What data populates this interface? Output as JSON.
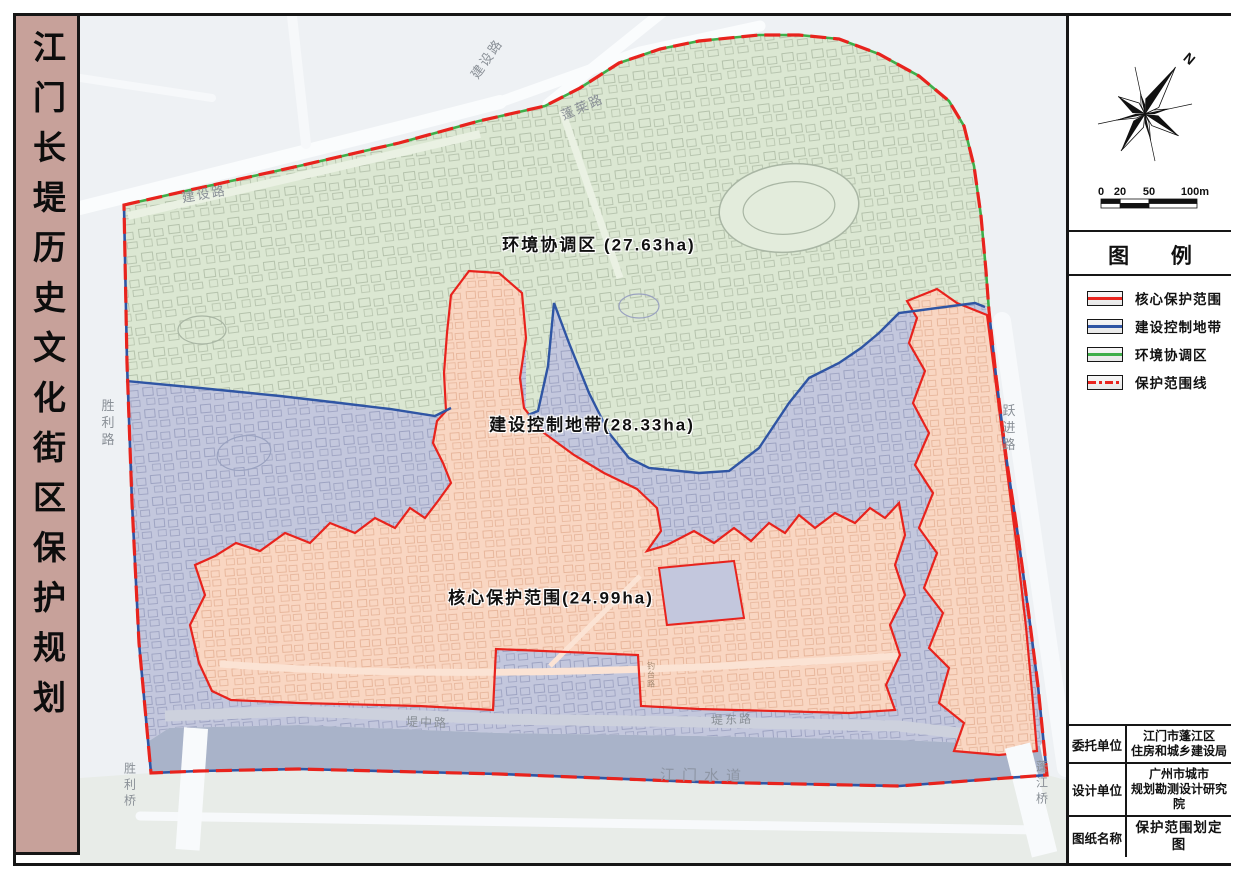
{
  "title_bar": {
    "text": "江门长堤历史文化街区保护规划"
  },
  "map": {
    "zone_labels": {
      "coordination": "环境协调区 (27.63ha)",
      "control": "建设控制地带(28.33ha)",
      "core": "核心保护范围(24.99ha)"
    },
    "road_labels": {
      "jianshe_lu_main": "建设路",
      "jianshe_lu_branch": "建设路",
      "penglai_lu": "蓬莱路",
      "shengli_lu": "胜利路",
      "yuejin_lu": "跃进路",
      "dizhong_lu": "堤中路",
      "didong_lu": "堤东路",
      "shengli_qiao": "胜利桥",
      "pengjiang_qiao": "蓬江桥",
      "diaotai_lu": "钓台路"
    },
    "river_label": "江门水道",
    "colors": {
      "core_fill": "#f9d6c2",
      "control_fill": "#c3c7dd",
      "coordination_fill": "#dbe7d2",
      "river_fill": "#a9b3c9",
      "core_line": "#e8231d",
      "control_line": "#2f55a4",
      "coordination_line": "#3fae49"
    }
  },
  "sidebar": {
    "north_label": "N",
    "scalebar": {
      "ticks": [
        "0",
        "20",
        "50",
        "100m"
      ]
    },
    "legend": {
      "title": "图  例",
      "items": [
        {
          "label": "核心保护范围"
        },
        {
          "label": "建设控制地带"
        },
        {
          "label": "环境协调区"
        },
        {
          "label": "保护范围线"
        }
      ]
    },
    "info_table": {
      "rows": [
        {
          "label": "委托单位",
          "line1": "江门市蓬江区",
          "line2": "住房和城乡建设局"
        },
        {
          "label": "设计单位",
          "line1": "广州市城市",
          "line2": "规划勘测设计研究院"
        },
        {
          "label": "图纸名称",
          "line1": "保护范围划定图",
          "line2": ""
        }
      ]
    }
  }
}
